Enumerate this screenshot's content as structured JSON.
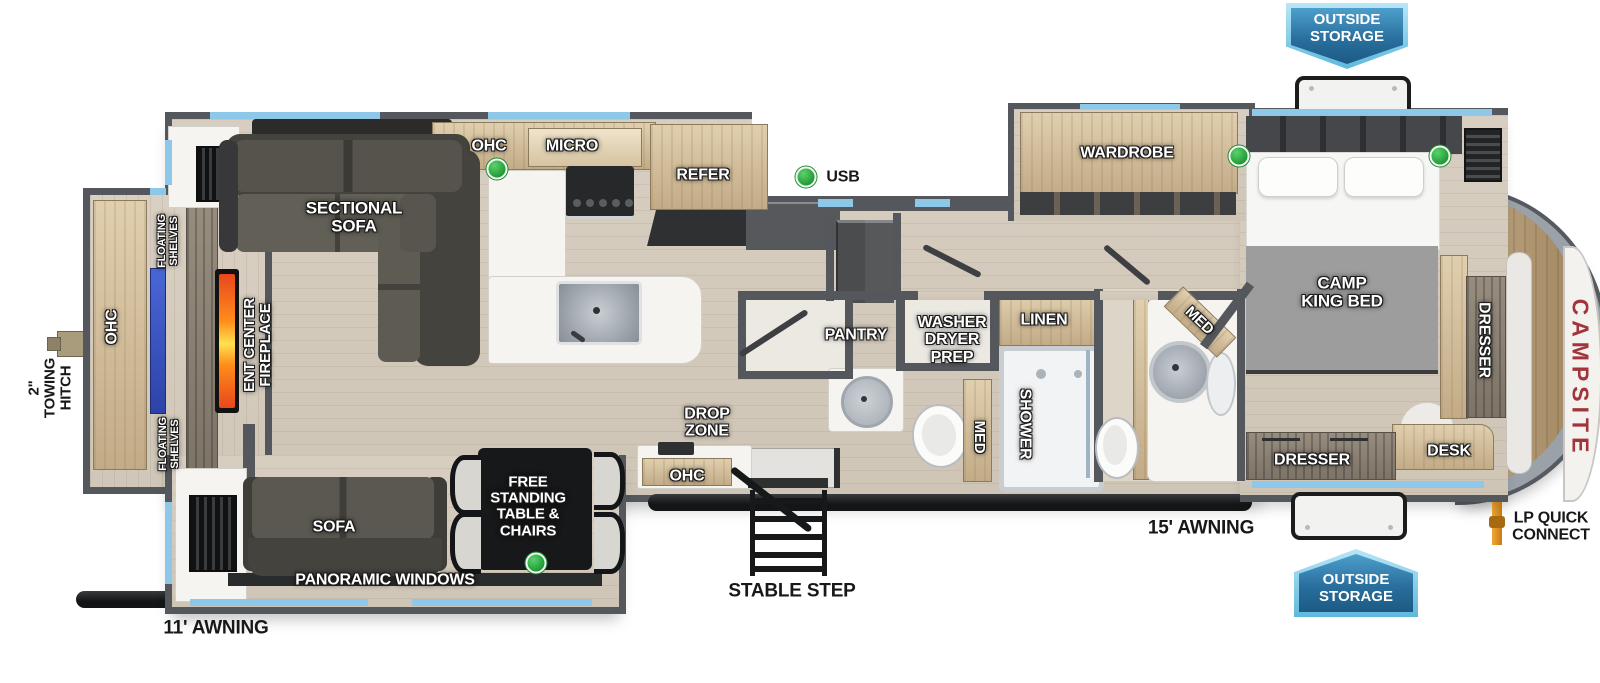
{
  "diagram_type": "rv-floorplan",
  "brand": {
    "nose_text": "CAMPSITE"
  },
  "badges": {
    "outside_storage_top": "OUTSIDE STORAGE",
    "outside_storage_bottom": "OUTSIDE STORAGE"
  },
  "plan": {
    "colors": {
      "wall": "#54575b",
      "window_blue": "#8ec8e8",
      "floor_wood": "#d4cabc",
      "cabinet_tan": "#c9b294",
      "badge_blue_dark": "#1b5a84",
      "badge_blue_light": "#8fd4f0",
      "indicator_green": "#2fa844",
      "brand_red": "#a2353b",
      "awning_black": "#1b1c1f",
      "fireplace_orange": "#f07316",
      "tv_blue": "#3c57c8",
      "lp_pipe_orange": "#d98e20"
    },
    "labels": [
      {
        "id": "sectional-sofa",
        "text": "SECTIONAL\nSOFA",
        "x": 354,
        "y": 218,
        "rot": 0,
        "cls": "w",
        "fs": 17
      },
      {
        "id": "ohc-kitchen",
        "text": "OHC",
        "x": 489,
        "y": 146,
        "rot": 0,
        "cls": "w",
        "fs": 16
      },
      {
        "id": "micro",
        "text": "MICRO",
        "x": 572,
        "y": 146,
        "rot": 0,
        "cls": "w",
        "fs": 16
      },
      {
        "id": "refer",
        "text": "REFER",
        "x": 703,
        "y": 175,
        "rot": 0,
        "cls": "w",
        "fs": 16
      },
      {
        "id": "usb",
        "text": "USB",
        "x": 843,
        "y": 177,
        "rot": 0,
        "cls": "k",
        "fs": 16
      },
      {
        "id": "wardrobe",
        "text": "WARDROBE",
        "x": 1127,
        "y": 153,
        "rot": 0,
        "cls": "w",
        "fs": 16
      },
      {
        "id": "camp-king-bed",
        "text": "CAMP\nKING BED",
        "x": 1342,
        "y": 293,
        "rot": 0,
        "cls": "w",
        "fs": 17
      },
      {
        "id": "dresser-front",
        "text": "DRESSER",
        "x": 1484,
        "y": 340,
        "rot": 90,
        "cls": "w",
        "fs": 16
      },
      {
        "id": "desk",
        "text": "DESK",
        "x": 1449,
        "y": 451,
        "rot": 0,
        "cls": "w",
        "fs": 16
      },
      {
        "id": "dresser-bedroom",
        "text": "DRESSER",
        "x": 1312,
        "y": 460,
        "rot": 0,
        "cls": "w",
        "fs": 16
      },
      {
        "id": "pantry",
        "text": "PANTRY",
        "x": 856,
        "y": 335,
        "rot": 0,
        "cls": "w",
        "fs": 16
      },
      {
        "id": "washer-dryer-prep",
        "text": "WASHER\nDRYER\nPREP",
        "x": 952,
        "y": 340,
        "rot": 0,
        "cls": "w",
        "fs": 16
      },
      {
        "id": "linen",
        "text": "LINEN",
        "x": 1044,
        "y": 320,
        "rot": 0,
        "cls": "w",
        "fs": 16
      },
      {
        "id": "shower",
        "text": "SHOWER",
        "x": 1025,
        "y": 424,
        "rot": 90,
        "cls": "w",
        "fs": 16
      },
      {
        "id": "med-bath",
        "text": "MED",
        "x": 979,
        "y": 437,
        "rot": 90,
        "cls": "w",
        "fs": 15
      },
      {
        "id": "med-master",
        "text": "MED",
        "x": 1199,
        "y": 321,
        "rot": 44,
        "cls": "w",
        "fs": 15
      },
      {
        "id": "drop-zone",
        "text": "DROP\nZONE",
        "x": 707,
        "y": 423,
        "rot": 0,
        "cls": "w",
        "fs": 16
      },
      {
        "id": "ohc-drop-zone",
        "text": "OHC",
        "x": 687,
        "y": 476,
        "rot": 0,
        "cls": "w",
        "fs": 16
      },
      {
        "id": "free-standing-table",
        "text": "FREE\nSTANDING\nTABLE &\nCHAIRS",
        "x": 528,
        "y": 507,
        "rot": 0,
        "cls": "w",
        "fs": 15
      },
      {
        "id": "sofa",
        "text": "SOFA",
        "x": 334,
        "y": 527,
        "rot": 0,
        "cls": "w",
        "fs": 16
      },
      {
        "id": "panoramic-windows",
        "text": "PANORAMIC WINDOWS",
        "x": 385,
        "y": 580,
        "rot": 0,
        "cls": "w",
        "fs": 16
      },
      {
        "id": "ent-center-fireplace",
        "text": "ENT CENTER\nFIREPLACE",
        "x": 258,
        "y": 345,
        "rot": -90,
        "cls": "w",
        "fs": 15
      },
      {
        "id": "ohc-rear",
        "text": "OHC",
        "x": 112,
        "y": 327,
        "rot": -90,
        "cls": "w",
        "fs": 16
      },
      {
        "id": "floating-shelves-top",
        "text": "FLOATING\nSHELVES",
        "x": 169,
        "y": 241,
        "rot": -90,
        "cls": "w",
        "fs": 11
      },
      {
        "id": "floating-shelves-bottom",
        "text": "FLOATING\nSHELVES",
        "x": 170,
        "y": 444,
        "rot": -90,
        "cls": "w",
        "fs": 11
      },
      {
        "id": "towing-hitch",
        "text": "2\"\nTOWING\nHITCH",
        "x": 51,
        "y": 388,
        "rot": -90,
        "cls": "k",
        "fs": 15
      },
      {
        "id": "awning-11",
        "text": "11' AWNING",
        "x": 216,
        "y": 629,
        "rot": 0,
        "cls": "k",
        "fs": 19
      },
      {
        "id": "stable-step",
        "text": "STABLE STEP",
        "x": 792,
        "y": 592,
        "rot": 0,
        "cls": "k",
        "fs": 19
      },
      {
        "id": "awning-15",
        "text": "15' AWNING",
        "x": 1201,
        "y": 529,
        "rot": 0,
        "cls": "k",
        "fs": 19
      },
      {
        "id": "lp-quick-connect",
        "text": "LP QUICK\nCONNECT",
        "x": 1551,
        "y": 527,
        "rot": 0,
        "cls": "k",
        "fs": 16
      },
      {
        "id": "campsite-brand",
        "text": "CAMPSITE",
        "x": 1580,
        "y": 378,
        "rot": 90,
        "cls": "brand",
        "fs": 23
      }
    ],
    "indicator_dots": [
      [
        497,
        169
      ],
      [
        806,
        177
      ],
      [
        1239,
        156
      ],
      [
        1440,
        156
      ],
      [
        536,
        563
      ]
    ]
  }
}
